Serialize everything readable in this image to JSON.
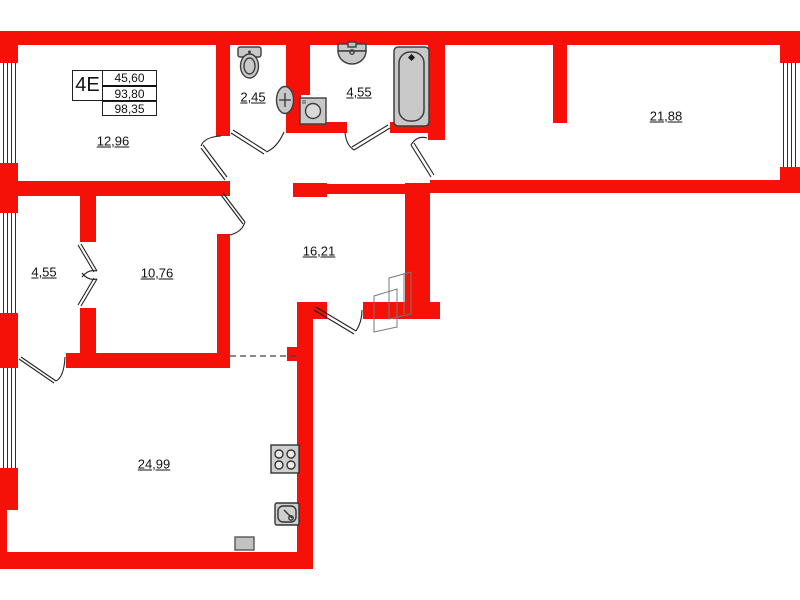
{
  "unit_info": {
    "unit": "4E",
    "values": [
      "45,60",
      "93,80",
      "98,35"
    ]
  },
  "rooms": [
    {
      "name": "room-top-left",
      "label": "12,96"
    },
    {
      "name": "wc",
      "label": "2,45"
    },
    {
      "name": "bathroom",
      "label": "4,55"
    },
    {
      "name": "room-top-right",
      "label": "21,88"
    },
    {
      "name": "closet",
      "label": "4,55"
    },
    {
      "name": "room-middle",
      "label": "10,76"
    },
    {
      "name": "hallway",
      "label": "16,21"
    },
    {
      "name": "living-kitchen",
      "label": "24,99"
    }
  ],
  "fixtures": [
    "toilet-icon",
    "wc-sink-icon",
    "washbasin-icon",
    "bathtub-icon",
    "washing-machine-icon",
    "stove-icon",
    "kitchen-sink-icon",
    "boiler-icon",
    "entrance-door-icon",
    "window-icon"
  ],
  "colors": {
    "wall": "#f51107",
    "fixture_fill": "#c9c9c9",
    "fixture_stroke": "#3d3d3d",
    "line": "#222222"
  }
}
